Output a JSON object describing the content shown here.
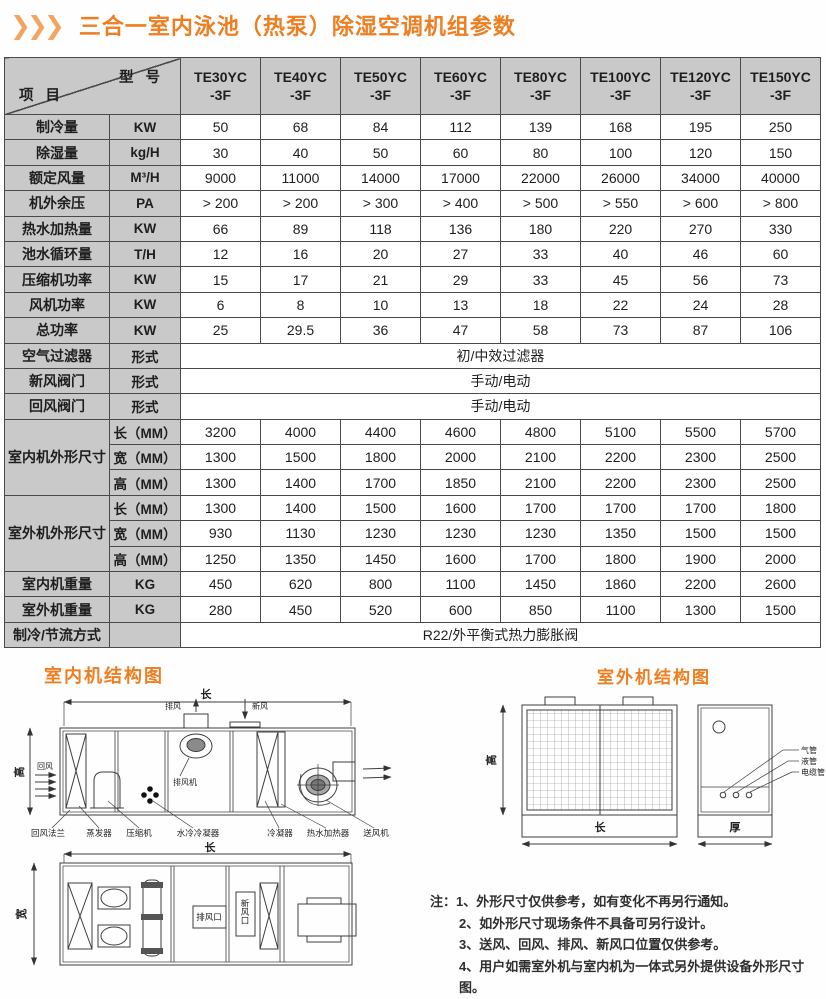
{
  "header": {
    "chevrons": "❯❯❯",
    "title": "三合一室内泳池（热泵）除湿空调机组参数"
  },
  "table": {
    "corner": {
      "top": "型 号",
      "bottom": "项 目"
    },
    "models": [
      [
        "TE30YC",
        "-3F"
      ],
      [
        "TE40YC",
        "-3F"
      ],
      [
        "TE50YC",
        "-3F"
      ],
      [
        "TE60YC",
        "-3F"
      ],
      [
        "TE80YC",
        "-3F"
      ],
      [
        "TE100YC",
        "-3F"
      ],
      [
        "TE120YC",
        "-3F"
      ],
      [
        "TE150YC",
        "-3F"
      ]
    ],
    "rows": [
      {
        "label": "制冷量",
        "unit": "KW",
        "values": [
          "50",
          "68",
          "84",
          "112",
          "139",
          "168",
          "195",
          "250"
        ]
      },
      {
        "label": "除湿量",
        "unit": "kg/H",
        "values": [
          "30",
          "40",
          "50",
          "60",
          "80",
          "100",
          "120",
          "150"
        ]
      },
      {
        "label": "额定风量",
        "unit": "M³/H",
        "values": [
          "9000",
          "11000",
          "14000",
          "17000",
          "22000",
          "26000",
          "34000",
          "40000"
        ]
      },
      {
        "label": "机外余压",
        "unit": "PA",
        "values": [
          "> 200",
          "> 200",
          "> 300",
          "> 400",
          "> 500",
          "> 550",
          "> 600",
          "> 800"
        ]
      },
      {
        "label": "热水加热量",
        "unit": "KW",
        "values": [
          "66",
          "89",
          "118",
          "136",
          "180",
          "220",
          "270",
          "330"
        ]
      },
      {
        "label": "池水循环量",
        "unit": "T/H",
        "values": [
          "12",
          "16",
          "20",
          "27",
          "33",
          "40",
          "46",
          "60"
        ]
      },
      {
        "label": "压缩机功率",
        "unit": "KW",
        "values": [
          "15",
          "17",
          "21",
          "29",
          "33",
          "45",
          "56",
          "73"
        ]
      },
      {
        "label": "风机功率",
        "unit": "KW",
        "values": [
          "6",
          "8",
          "10",
          "13",
          "18",
          "22",
          "24",
          "28"
        ]
      },
      {
        "label": "总功率",
        "unit": "KW",
        "values": [
          "25",
          "29.5",
          "36",
          "47",
          "58",
          "73",
          "87",
          "106"
        ]
      },
      {
        "label": "空气过滤器",
        "unit": "形式",
        "span": "初/中效过滤器"
      },
      {
        "label": "新风阀门",
        "unit": "形式",
        "span": "手动/电动"
      },
      {
        "label": "回风阀门",
        "unit": "形式",
        "span": "手动/电动"
      },
      {
        "group": "室内机外形尺寸",
        "subrows": [
          {
            "unit": "长（MM）",
            "values": [
              "3200",
              "4000",
              "4400",
              "4600",
              "4800",
              "5100",
              "5500",
              "5700"
            ]
          },
          {
            "unit": "宽（MM）",
            "values": [
              "1300",
              "1500",
              "1800",
              "2000",
              "2100",
              "2200",
              "2300",
              "2500"
            ]
          },
          {
            "unit": "高（MM）",
            "values": [
              "1300",
              "1400",
              "1700",
              "1850",
              "2100",
              "2200",
              "2300",
              "2500"
            ]
          }
        ]
      },
      {
        "group": "室外机外形尺寸",
        "subrows": [
          {
            "unit": "长（MM）",
            "values": [
              "1300",
              "1400",
              "1500",
              "1600",
              "1700",
              "1700",
              "1700",
              "1800"
            ]
          },
          {
            "unit": "宽（MM）",
            "values": [
              "930",
              "1130",
              "1230",
              "1230",
              "1230",
              "1350",
              "1500",
              "1500"
            ]
          },
          {
            "unit": "高（MM）",
            "values": [
              "1250",
              "1350",
              "1450",
              "1600",
              "1700",
              "1800",
              "1900",
              "2000"
            ]
          }
        ]
      },
      {
        "label": "室内机重量",
        "unit": "KG",
        "values": [
          "450",
          "620",
          "800",
          "1100",
          "1450",
          "1860",
          "2200",
          "2600"
        ]
      },
      {
        "label": "室外机重量",
        "unit": "KG",
        "values": [
          "280",
          "450",
          "520",
          "600",
          "850",
          "1100",
          "1300",
          "1500"
        ]
      },
      {
        "label": "制冷/节流方式",
        "unit": "",
        "span": "R22/外平衡式热力膨胀阀"
      }
    ]
  },
  "diagrams": {
    "indoor": {
      "heading": "室内机结构图",
      "side_view": {
        "dim_length": "长",
        "dim_height": "高",
        "return_air": "回风",
        "exhaust_air": "排风",
        "fresh_air": "新风",
        "exhaust_fan": "排风机",
        "labels": [
          "回风法兰",
          "蒸发器",
          "压缩机",
          "水冷冷凝器",
          "冷凝器",
          "热水加热器",
          "送风机"
        ]
      },
      "top_view": {
        "dim_length": "长",
        "dim_width": "宽",
        "exhaust_vent": "排风口",
        "fresh_vent": "新风口"
      }
    },
    "outdoor": {
      "heading": "室外机结构图",
      "dim_height": "高",
      "dim_length": "长",
      "dim_depth": "厚",
      "pipe_labels": [
        "气管",
        "液管",
        "电缆管"
      ]
    }
  },
  "notes": {
    "lines": [
      "注：1、外形尺寸仅供参考，如有变化不再另行通知。",
      "2、如外形尺寸现场条件不具备可另行设计。",
      "3、送风、回风、排风、新风口位置仅供参考。",
      "4、用户如需室外机与室内机为一体式另外提供设备外形尺寸图。"
    ]
  },
  "colors": {
    "accent_orange": "#ee7e20",
    "chevron_orange": "#f3a55f",
    "table_gray": "#c9c9c9",
    "border": "#4a4a4a"
  }
}
